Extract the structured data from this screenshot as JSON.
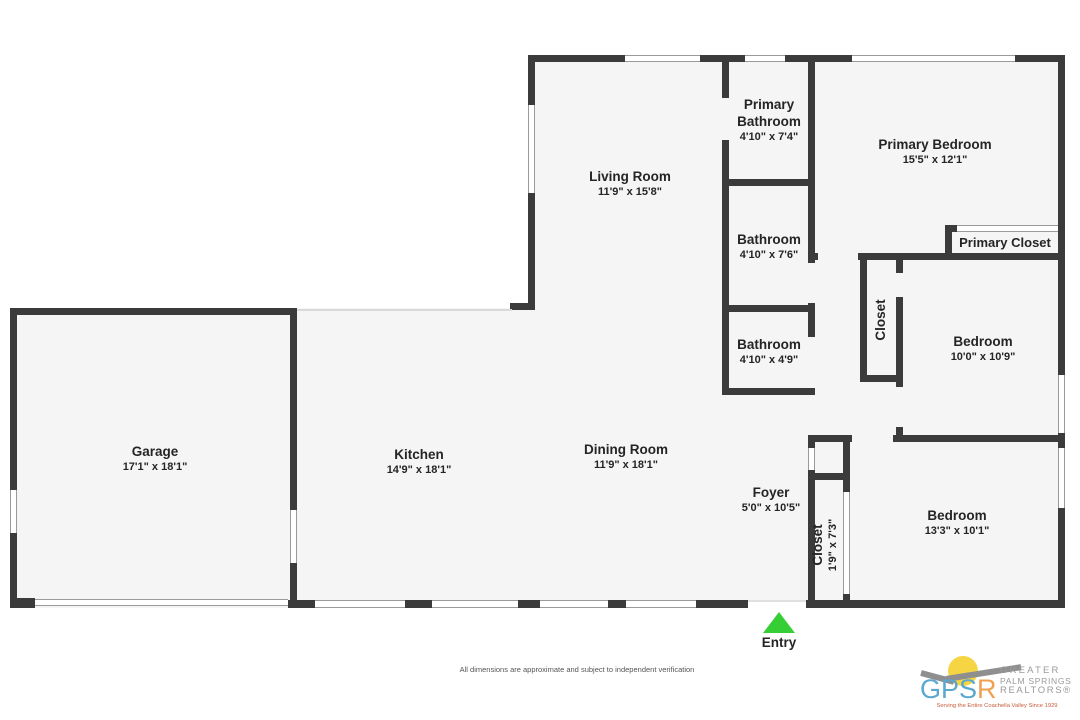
{
  "plan": {
    "rooms": {
      "living_room": {
        "name": "Living Room",
        "dims": "11'9\" x 15'8\""
      },
      "primary_bathroom": {
        "name": "Primary Bathroom",
        "dims": "4'10\" x 7'4\""
      },
      "primary_bedroom": {
        "name": "Primary Bedroom",
        "dims": "15'5\" x 12'1\""
      },
      "bathroom_upper": {
        "name": "Bathroom",
        "dims": "4'10\" x 7'6\""
      },
      "primary_closet": {
        "name": "Primary Closet"
      },
      "closet_mid": {
        "name": "Closet"
      },
      "bedroom_mid": {
        "name": "Bedroom",
        "dims": "10'0\" x 10'9\""
      },
      "bathroom_lower": {
        "name": "Bathroom",
        "dims": "4'10\" x 4'9\""
      },
      "garage": {
        "name": "Garage",
        "dims": "17'1\" x 18'1\""
      },
      "kitchen": {
        "name": "Kitchen",
        "dims": "14'9\" x 18'1\""
      },
      "dining_room": {
        "name": "Dining Room",
        "dims": "11'9\" x 18'1\""
      },
      "foyer": {
        "name": "Foyer",
        "dims": "5'0\" x 10'5\""
      },
      "closet_foyer": {
        "name": "Closet",
        "dims": "1'9\" x 7'3\""
      },
      "bedroom_lower": {
        "name": "Bedroom",
        "dims": "13'3\" x 10'1\""
      }
    },
    "entry_label": "Entry"
  },
  "footer": {
    "disclaimer": "All dimensions are approximate and subject to independent verification"
  },
  "logo": {
    "acronym_blue": "GPS",
    "acronym_orange": "R",
    "line1": "GREATER",
    "line2": "PALM SPRINGS",
    "line3": "REALTORS®",
    "tagline": "Serving the Entire Coachella Valley Since 1929"
  },
  "colors": {
    "wall": "#3b3b3b",
    "floor": "#f5f5f5",
    "entry_arrow": "#35cf35",
    "logo_blue": "#5aa7cf",
    "logo_orange": "#f0a050",
    "logo_gray": "#9a9a9a",
    "logo_tagline_red": "#c75b39"
  }
}
